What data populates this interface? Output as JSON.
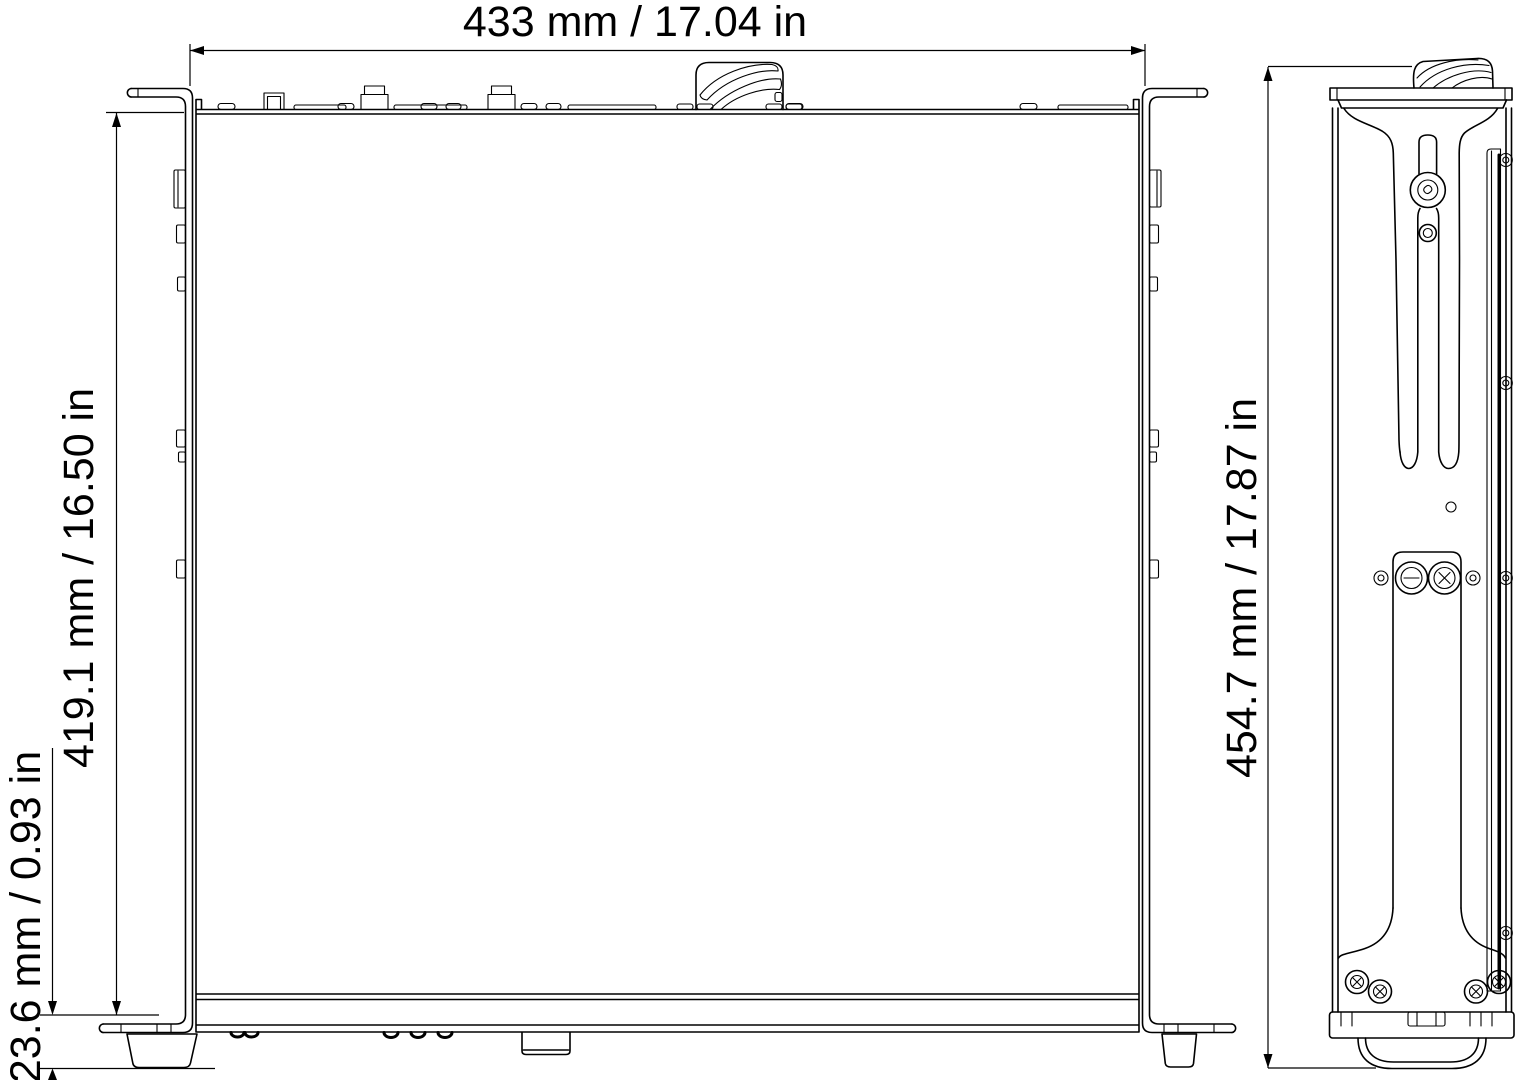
{
  "drawing": {
    "kind": "mechanical-dimension-drawing",
    "colors": {
      "line": "#000000",
      "background": "#ffffff"
    }
  },
  "dimensions": {
    "width": {
      "label": "433 mm / 17.04 in"
    },
    "height": {
      "label": "419.1 mm / 16.50 in"
    },
    "foot_height": {
      "label": "23.6 mm / 0.93 in"
    },
    "depth": {
      "label": "454.7 mm / 17.87 in"
    }
  }
}
